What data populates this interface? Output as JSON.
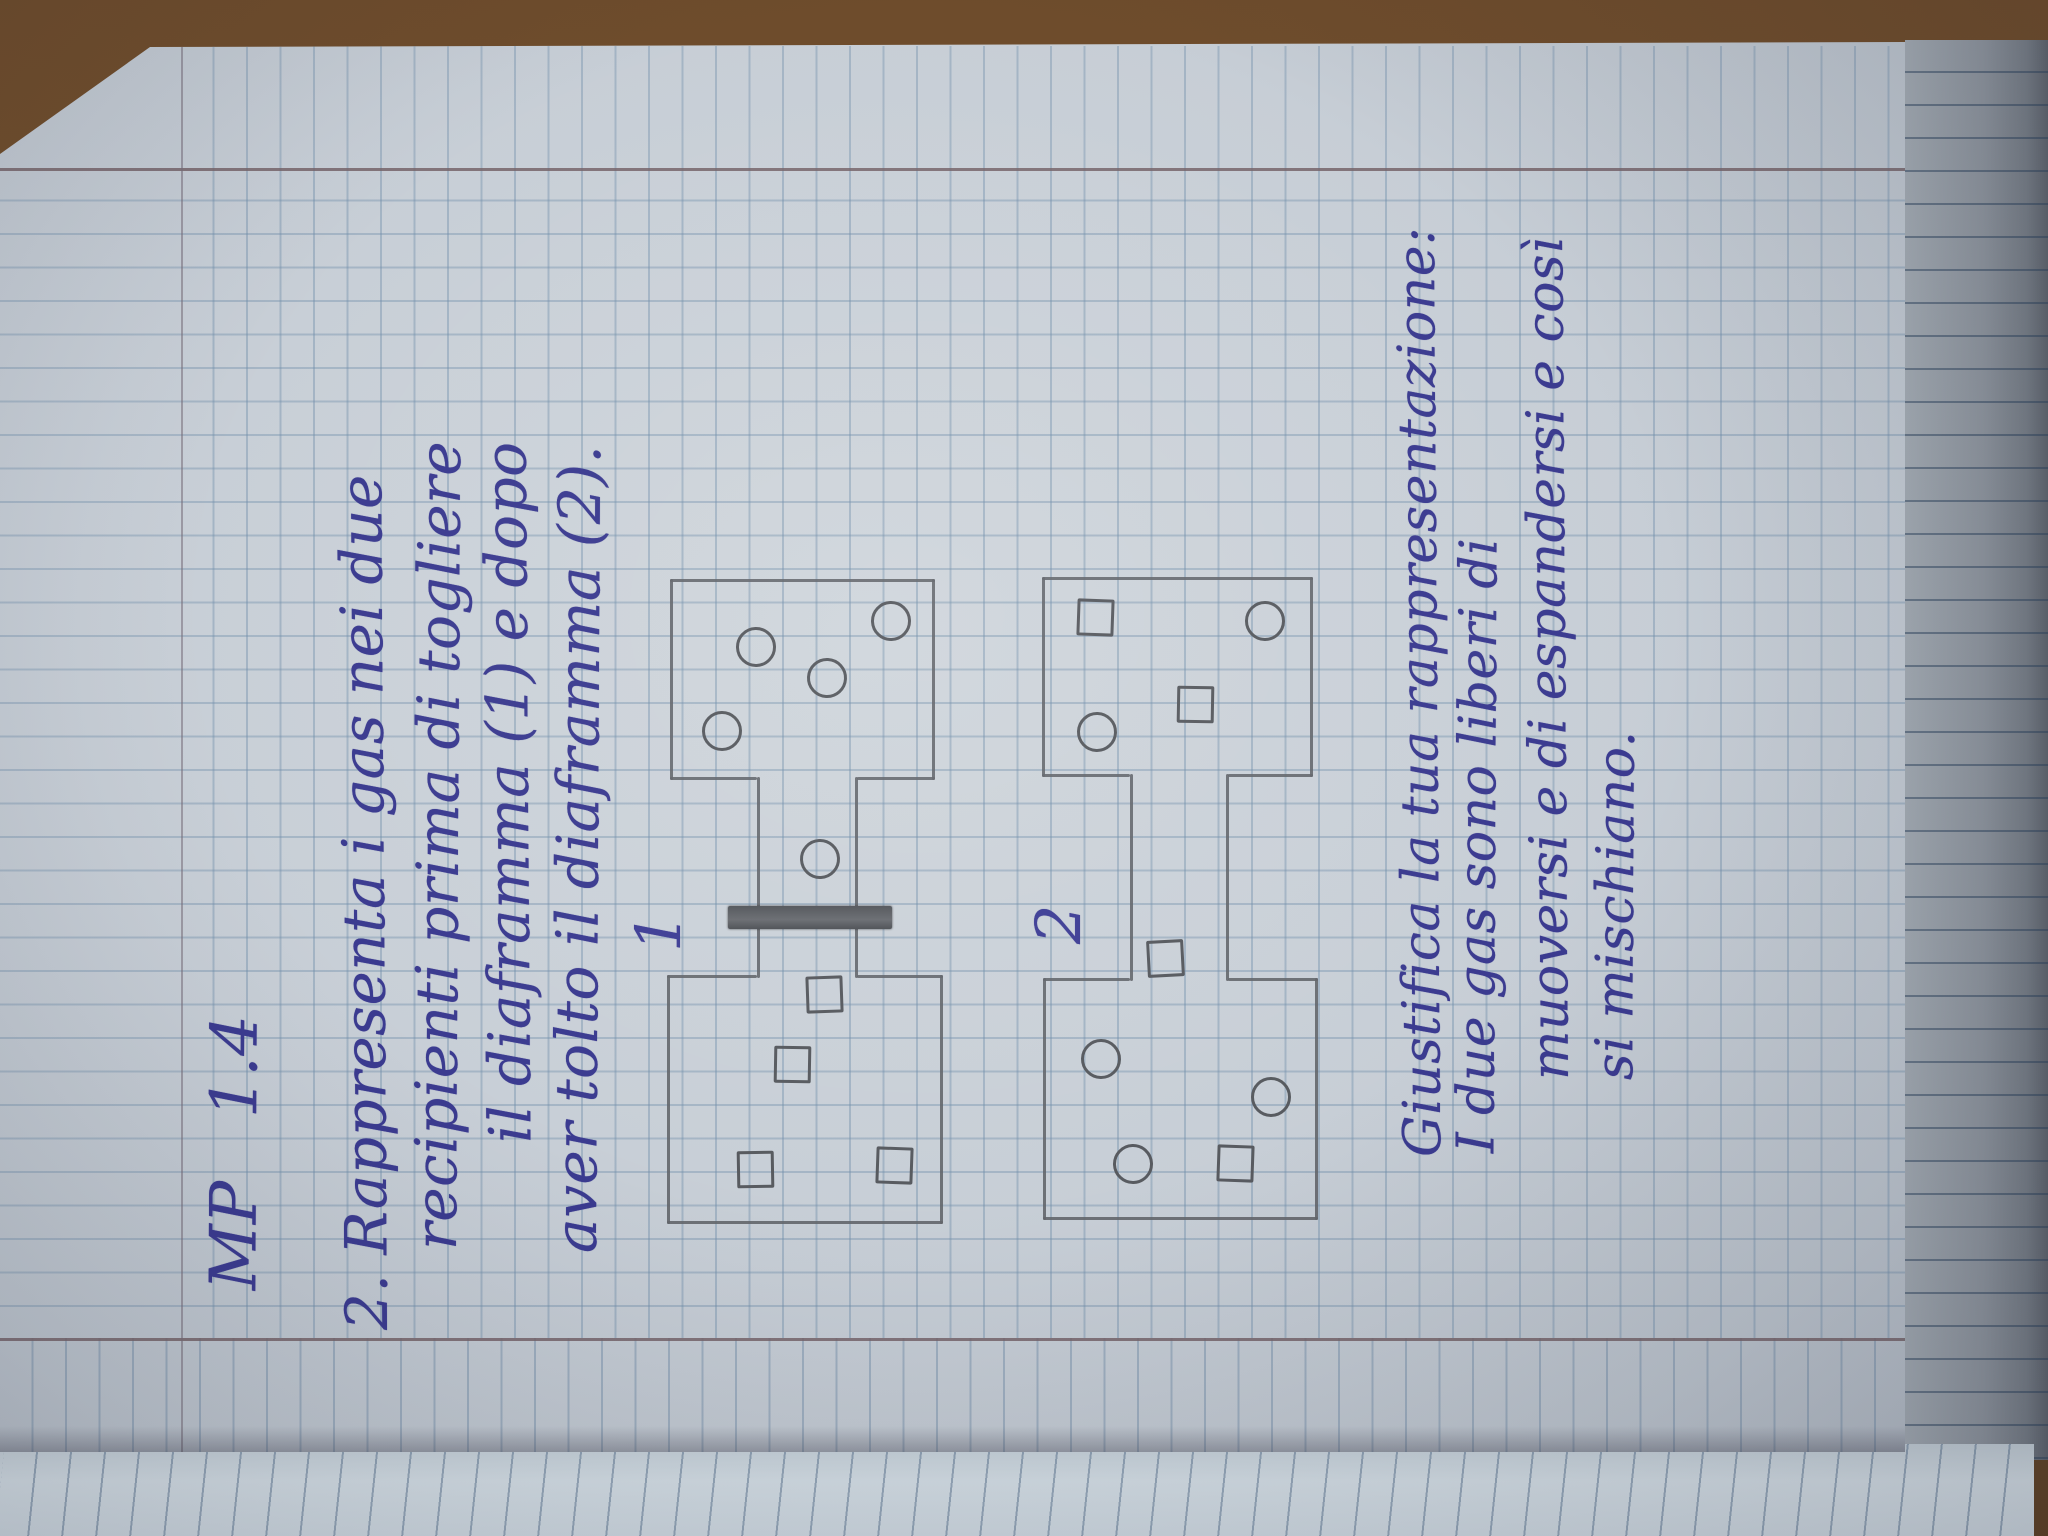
{
  "photo_description": {
    "subject": "handwritten squared-notebook page photographed rotated 90 degrees counter-clockwise",
    "paper_color": "#c7ced6",
    "grid_color": "#7e9ab4",
    "margin_line_color": "#766a6a",
    "wood_desk_color": "#6e4c2c",
    "ink_color": "#3b3b90",
    "pencil_color": "#63666b"
  },
  "handwriting": {
    "header_code": "MP   1.4",
    "lines": [
      {
        "text": "MP   1.4",
        "x": 246,
        "y": 198,
        "size": 64
      },
      {
        "text": "2. Rappresenta i gas nei due",
        "x": 206,
        "y": 330,
        "size": 58
      },
      {
        "text": "recipienti prima di togliere",
        "x": 286,
        "y": 404,
        "size": 58
      },
      {
        "text": "il diaframma (1) e dopo",
        "x": 393,
        "y": 474,
        "size": 58
      },
      {
        "text": "aver tolto il diaframma (2).",
        "x": 283,
        "y": 544,
        "size": 58
      },
      {
        "text": "Giustifica la tua rappresentazione:",
        "x": 379,
        "y": 1390,
        "size": 52
      },
      {
        "text": "I due gas sono liberi di",
        "x": 383,
        "y": 1448,
        "size": 52
      },
      {
        "text": "muoversi e di espandersi e così",
        "x": 456,
        "y": 1518,
        "size": 52
      },
      {
        "text": "si mischiano.",
        "x": 456,
        "y": 1586,
        "size": 52
      }
    ]
  },
  "diagram": {
    "figure_1_label": "1",
    "figure_2_label": "2",
    "figure_1": {
      "description": "two containers joined by a channel closed by a shaded diaphragm; left container holds square particles, right container holds circle particles, one circle in the channel right of the diaphragm",
      "has_diaphragm": true
    },
    "figure_2": {
      "description": "same two joined containers with the diaphragm removed; circle and square particles mixed in both containers and channel",
      "has_diaphragm": false
    },
    "particles": [
      {
        "fig": 1,
        "shape": "circle",
        "x": 802,
        "y": 719
      },
      {
        "fig": 1,
        "shape": "circle",
        "x": 886,
        "y": 753
      },
      {
        "fig": 1,
        "shape": "circle",
        "x": 855,
        "y": 824
      },
      {
        "fig": 1,
        "shape": "circle",
        "x": 912,
        "y": 888
      },
      {
        "fig": 1,
        "shape": "circle",
        "x": 674,
        "y": 817
      },
      {
        "fig": 1,
        "shape": "square",
        "x": 538,
        "y": 821
      },
      {
        "fig": 1,
        "shape": "square",
        "x": 468,
        "y": 789
      },
      {
        "fig": 1,
        "shape": "square",
        "x": 363,
        "y": 752
      },
      {
        "fig": 1,
        "shape": "square",
        "x": 367,
        "y": 891
      },
      {
        "fig": 2,
        "shape": "square",
        "x": 915,
        "y": 1092
      },
      {
        "fig": 2,
        "shape": "circle",
        "x": 912,
        "y": 1262
      },
      {
        "fig": 2,
        "shape": "square",
        "x": 828,
        "y": 1192
      },
      {
        "fig": 2,
        "shape": "circle",
        "x": 801,
        "y": 1094
      },
      {
        "fig": 2,
        "shape": "square",
        "x": 574,
        "y": 1162
      },
      {
        "fig": 2,
        "shape": "circle",
        "x": 474,
        "y": 1098
      },
      {
        "fig": 2,
        "shape": "circle",
        "x": 436,
        "y": 1268
      },
      {
        "fig": 2,
        "shape": "circle",
        "x": 369,
        "y": 1130
      },
      {
        "fig": 2,
        "shape": "square",
        "x": 369,
        "y": 1232
      }
    ]
  }
}
